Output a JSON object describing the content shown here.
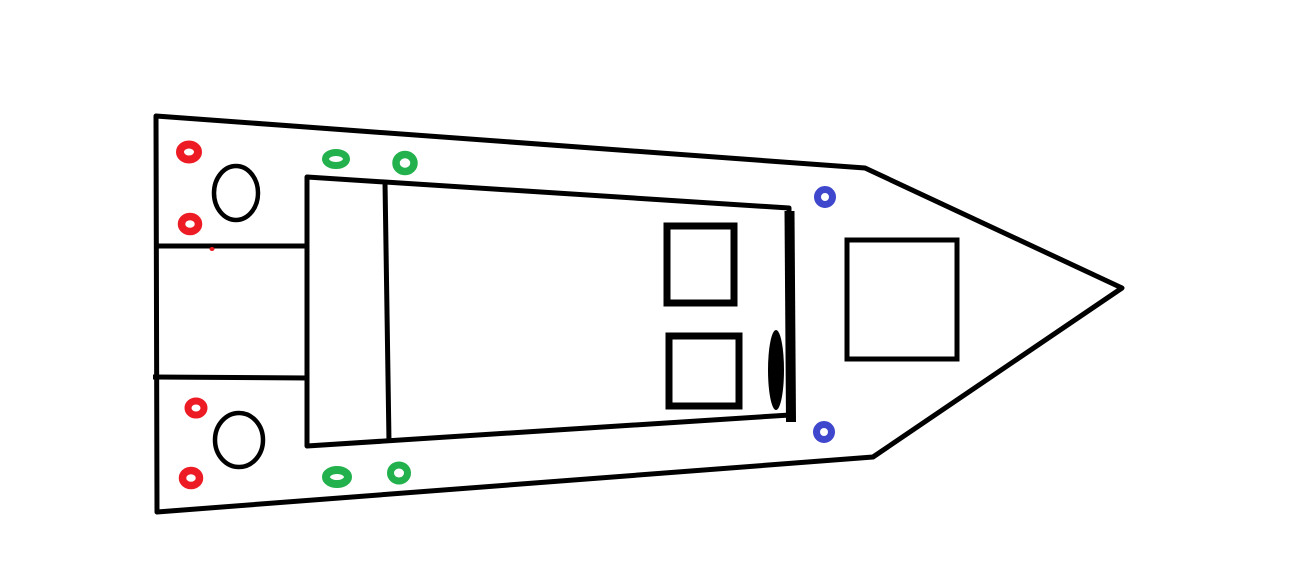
{
  "canvas": {
    "width": 1316,
    "height": 583,
    "background": "#FFFFFF"
  },
  "palette": {
    "line_color": "#000000",
    "red_marker_color": "#ED1C24",
    "green_marker_color": "#22B14C",
    "blue_marker_color": "#3F48CC"
  },
  "drawing": {
    "title_semantic": "hand-drawn boat deck top-view plan, bow pointing right",
    "shapes": [
      {
        "name": "hull-outline",
        "tag": "polygon",
        "attrs": {
          "points": "156,116 865,168 1122,288 873,457 157,512",
          "fill": "none",
          "stroke": "#000000",
          "stroke-width": "5",
          "stroke-linejoin": "round"
        }
      },
      {
        "name": "motorwell-top-line",
        "tag": "line",
        "attrs": {
          "x1": "154",
          "y1": "246",
          "x2": "309",
          "y2": "246",
          "stroke": "#000000",
          "stroke-width": "5"
        }
      },
      {
        "name": "motorwell-bottom-line",
        "tag": "line",
        "attrs": {
          "x1": "153",
          "y1": "377",
          "x2": "309",
          "y2": "378",
          "stroke": "#000000",
          "stroke-width": "5"
        }
      },
      {
        "name": "cockpit-outline",
        "tag": "polygon",
        "attrs": {
          "points": "307,177 789,208 790,415 307,446",
          "fill": "none",
          "stroke": "#000000",
          "stroke-width": "5",
          "stroke-linejoin": "round"
        }
      },
      {
        "name": "cockpit-bulkhead-thick-line",
        "tag": "line",
        "attrs": {
          "x1": "789.5",
          "y1": "211",
          "x2": "791",
          "y2": "422",
          "stroke": "#000000",
          "stroke-width": "10"
        }
      },
      {
        "name": "seat-divider-line",
        "tag": "line",
        "attrs": {
          "x1": "385",
          "y1": "182",
          "x2": "389",
          "y2": "442",
          "stroke": "#000000",
          "stroke-width": "5"
        }
      },
      {
        "name": "hatch-square-top",
        "tag": "rect",
        "attrs": {
          "x": "667",
          "y": "226",
          "width": "67",
          "height": "77",
          "fill": "none",
          "stroke": "#000000",
          "stroke-width": "7"
        }
      },
      {
        "name": "hatch-square-bottom",
        "tag": "rect",
        "attrs": {
          "x": "669",
          "y": "336",
          "width": "70",
          "height": "70",
          "fill": "none",
          "stroke": "#000000",
          "stroke-width": "7"
        }
      },
      {
        "name": "bow-hatch-square",
        "tag": "rect",
        "attrs": {
          "x": "847",
          "y": "240",
          "width": "110",
          "height": "119",
          "fill": "none",
          "stroke": "#000000",
          "stroke-width": "5"
        }
      },
      {
        "name": "bulkhead-lever-filled-oval",
        "tag": "ellipse",
        "attrs": {
          "cx": "776",
          "cy": "370",
          "rx": "8",
          "ry": "40",
          "fill": "#000000"
        }
      },
      {
        "name": "stern-circle-top",
        "tag": "ellipse",
        "attrs": {
          "cx": "236",
          "cy": "193",
          "rx": "22",
          "ry": "27",
          "fill": "none",
          "stroke": "#000000",
          "stroke-width": "4.5"
        }
      },
      {
        "name": "stern-circle-bottom",
        "tag": "ellipse",
        "attrs": {
          "cx": "239",
          "cy": "440",
          "rx": "24",
          "ry": "27",
          "fill": "none",
          "stroke": "#000000",
          "stroke-width": "4.5"
        }
      },
      {
        "name": "red-marker-stern-top-1",
        "tag": "ellipse",
        "attrs": {
          "cx": "189",
          "cy": "152",
          "rx": "9",
          "ry": "7.5",
          "fill": "none",
          "stroke": "#ED1C24",
          "stroke-width": "8"
        }
      },
      {
        "name": "red-marker-stern-top-2",
        "tag": "ellipse",
        "attrs": {
          "cx": "190",
          "cy": "224",
          "rx": "8.5",
          "ry": "7.5",
          "fill": "none",
          "stroke": "#ED1C24",
          "stroke-width": "7.5"
        }
      },
      {
        "name": "red-marker-stern-bottom-1",
        "tag": "ellipse",
        "attrs": {
          "cx": "196",
          "cy": "408",
          "rx": "8",
          "ry": "7",
          "fill": "none",
          "stroke": "#ED1C24",
          "stroke-width": "7"
        }
      },
      {
        "name": "red-marker-stern-bottom-2",
        "tag": "ellipse",
        "attrs": {
          "cx": "191",
          "cy": "478",
          "rx": "8.5",
          "ry": "7.5",
          "fill": "none",
          "stroke": "#ED1C24",
          "stroke-width": "7.5"
        }
      },
      {
        "name": "green-marker-port-1",
        "tag": "ellipse",
        "attrs": {
          "cx": "336",
          "cy": "159",
          "rx": "10.5",
          "ry": "6.5",
          "fill": "none",
          "stroke": "#22B14C",
          "stroke-width": "7"
        }
      },
      {
        "name": "green-marker-port-2",
        "tag": "ellipse",
        "attrs": {
          "cx": "405",
          "cy": "163",
          "rx": "9",
          "ry": "8.5",
          "fill": "none",
          "stroke": "#22B14C",
          "stroke-width": "7.5"
        }
      },
      {
        "name": "green-marker-starboard-1",
        "tag": "ellipse",
        "attrs": {
          "cx": "337",
          "cy": "477",
          "rx": "11",
          "ry": "7",
          "fill": "none",
          "stroke": "#22B14C",
          "stroke-width": "8"
        }
      },
      {
        "name": "green-marker-starboard-2",
        "tag": "ellipse",
        "attrs": {
          "cx": "399",
          "cy": "473",
          "rx": "8.5",
          "ry": "8",
          "fill": "none",
          "stroke": "#22B14C",
          "stroke-width": "7"
        }
      },
      {
        "name": "blue-marker-bow-top",
        "tag": "ellipse",
        "attrs": {
          "cx": "825",
          "cy": "197",
          "rx": "7.5",
          "ry": "7.5",
          "fill": "none",
          "stroke": "#3F48CC",
          "stroke-width": "7"
        }
      },
      {
        "name": "blue-marker-bow-bottom",
        "tag": "ellipse",
        "attrs": {
          "cx": "824",
          "cy": "432",
          "rx": "7.5",
          "ry": "7.5",
          "fill": "none",
          "stroke": "#3F48CC",
          "stroke-width": "7"
        }
      },
      {
        "name": "stray-red-dot",
        "tag": "ellipse",
        "attrs": {
          "cx": "212",
          "cy": "249",
          "rx": "2.5",
          "ry": "2",
          "fill": "#ED1C24"
        }
      }
    ]
  }
}
